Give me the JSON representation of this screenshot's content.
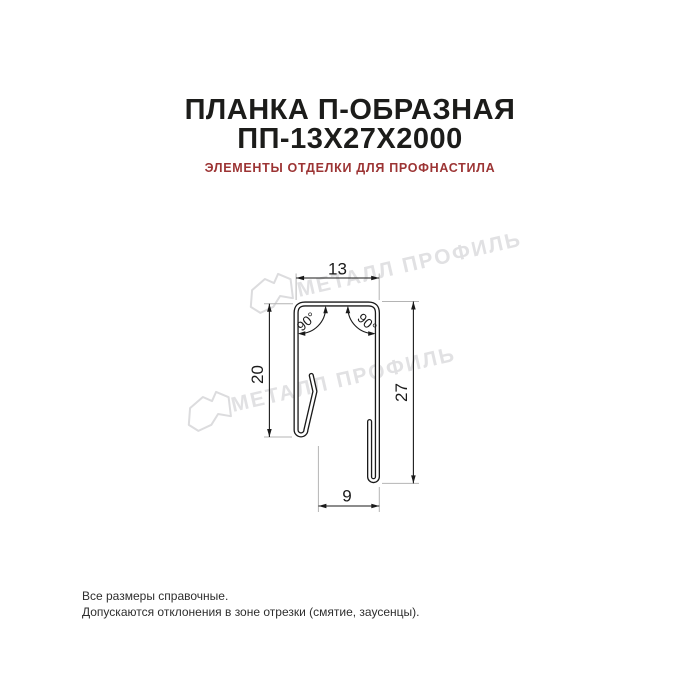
{
  "header": {
    "title_line1": "ПЛАНКА П-ОБРАЗНАЯ",
    "title_line2": "ПП-13Х27Х2000",
    "subtitle": "ЭЛЕМЕНТЫ ОТДЕЛКИ ДЛЯ ПРОФНАСТИЛА"
  },
  "drawing": {
    "dimensions": {
      "top_width": "13",
      "left_height": "20",
      "right_height": "27",
      "bottom_width": "9",
      "angle_left": "90°",
      "angle_right": "90°"
    }
  },
  "watermark": {
    "text": "МЕТАЛЛ ПРОФИЛЬ"
  },
  "footer": {
    "line1": "Все размеры справочные.",
    "line2": "Допускаются отклонения в зоне отрезки (смятие, заусенцы)."
  },
  "colors": {
    "title_black": "#1c1c1a",
    "subtitle_red": "#9c3434",
    "drawing_line": "#1a1a1a",
    "extension_gray": "#b4b4b4",
    "watermark_gray": "#e1e1e3"
  }
}
